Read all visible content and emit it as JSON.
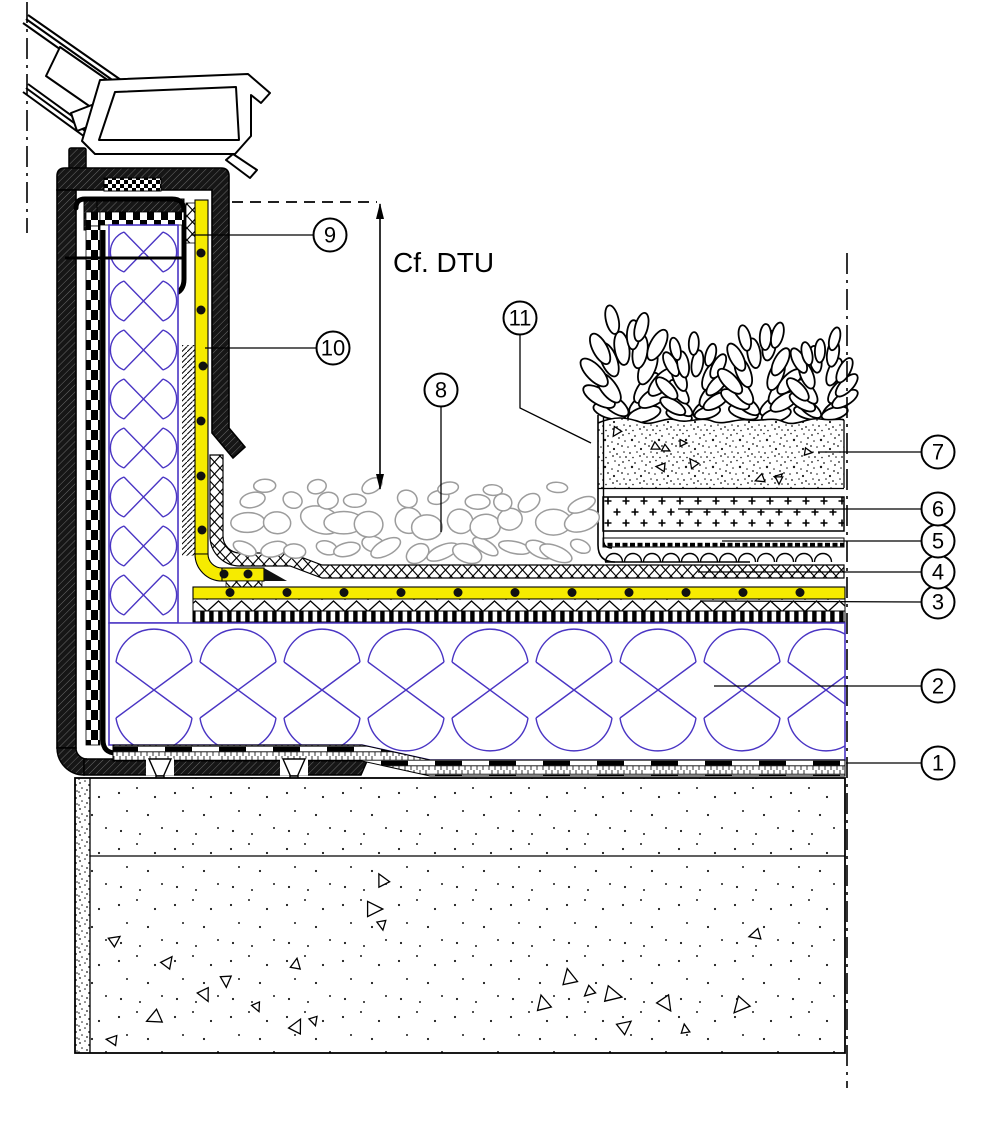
{
  "drawing": {
    "type": "construction-section-detail",
    "dimension_note": "Cf. DTU",
    "callouts": [
      {
        "label": "1"
      },
      {
        "label": "2"
      },
      {
        "label": "3"
      },
      {
        "label": "4"
      },
      {
        "label": "5"
      },
      {
        "label": "6"
      },
      {
        "label": "7"
      },
      {
        "label": "8"
      },
      {
        "label": "9"
      },
      {
        "label": "10"
      },
      {
        "label": "11"
      }
    ]
  },
  "colors": {
    "membrane_yellow": "#f6eb00",
    "insulation_blue": "#4a35c4",
    "pebble_gray": "#9c9c9c",
    "hatch_dark": "#161616"
  }
}
